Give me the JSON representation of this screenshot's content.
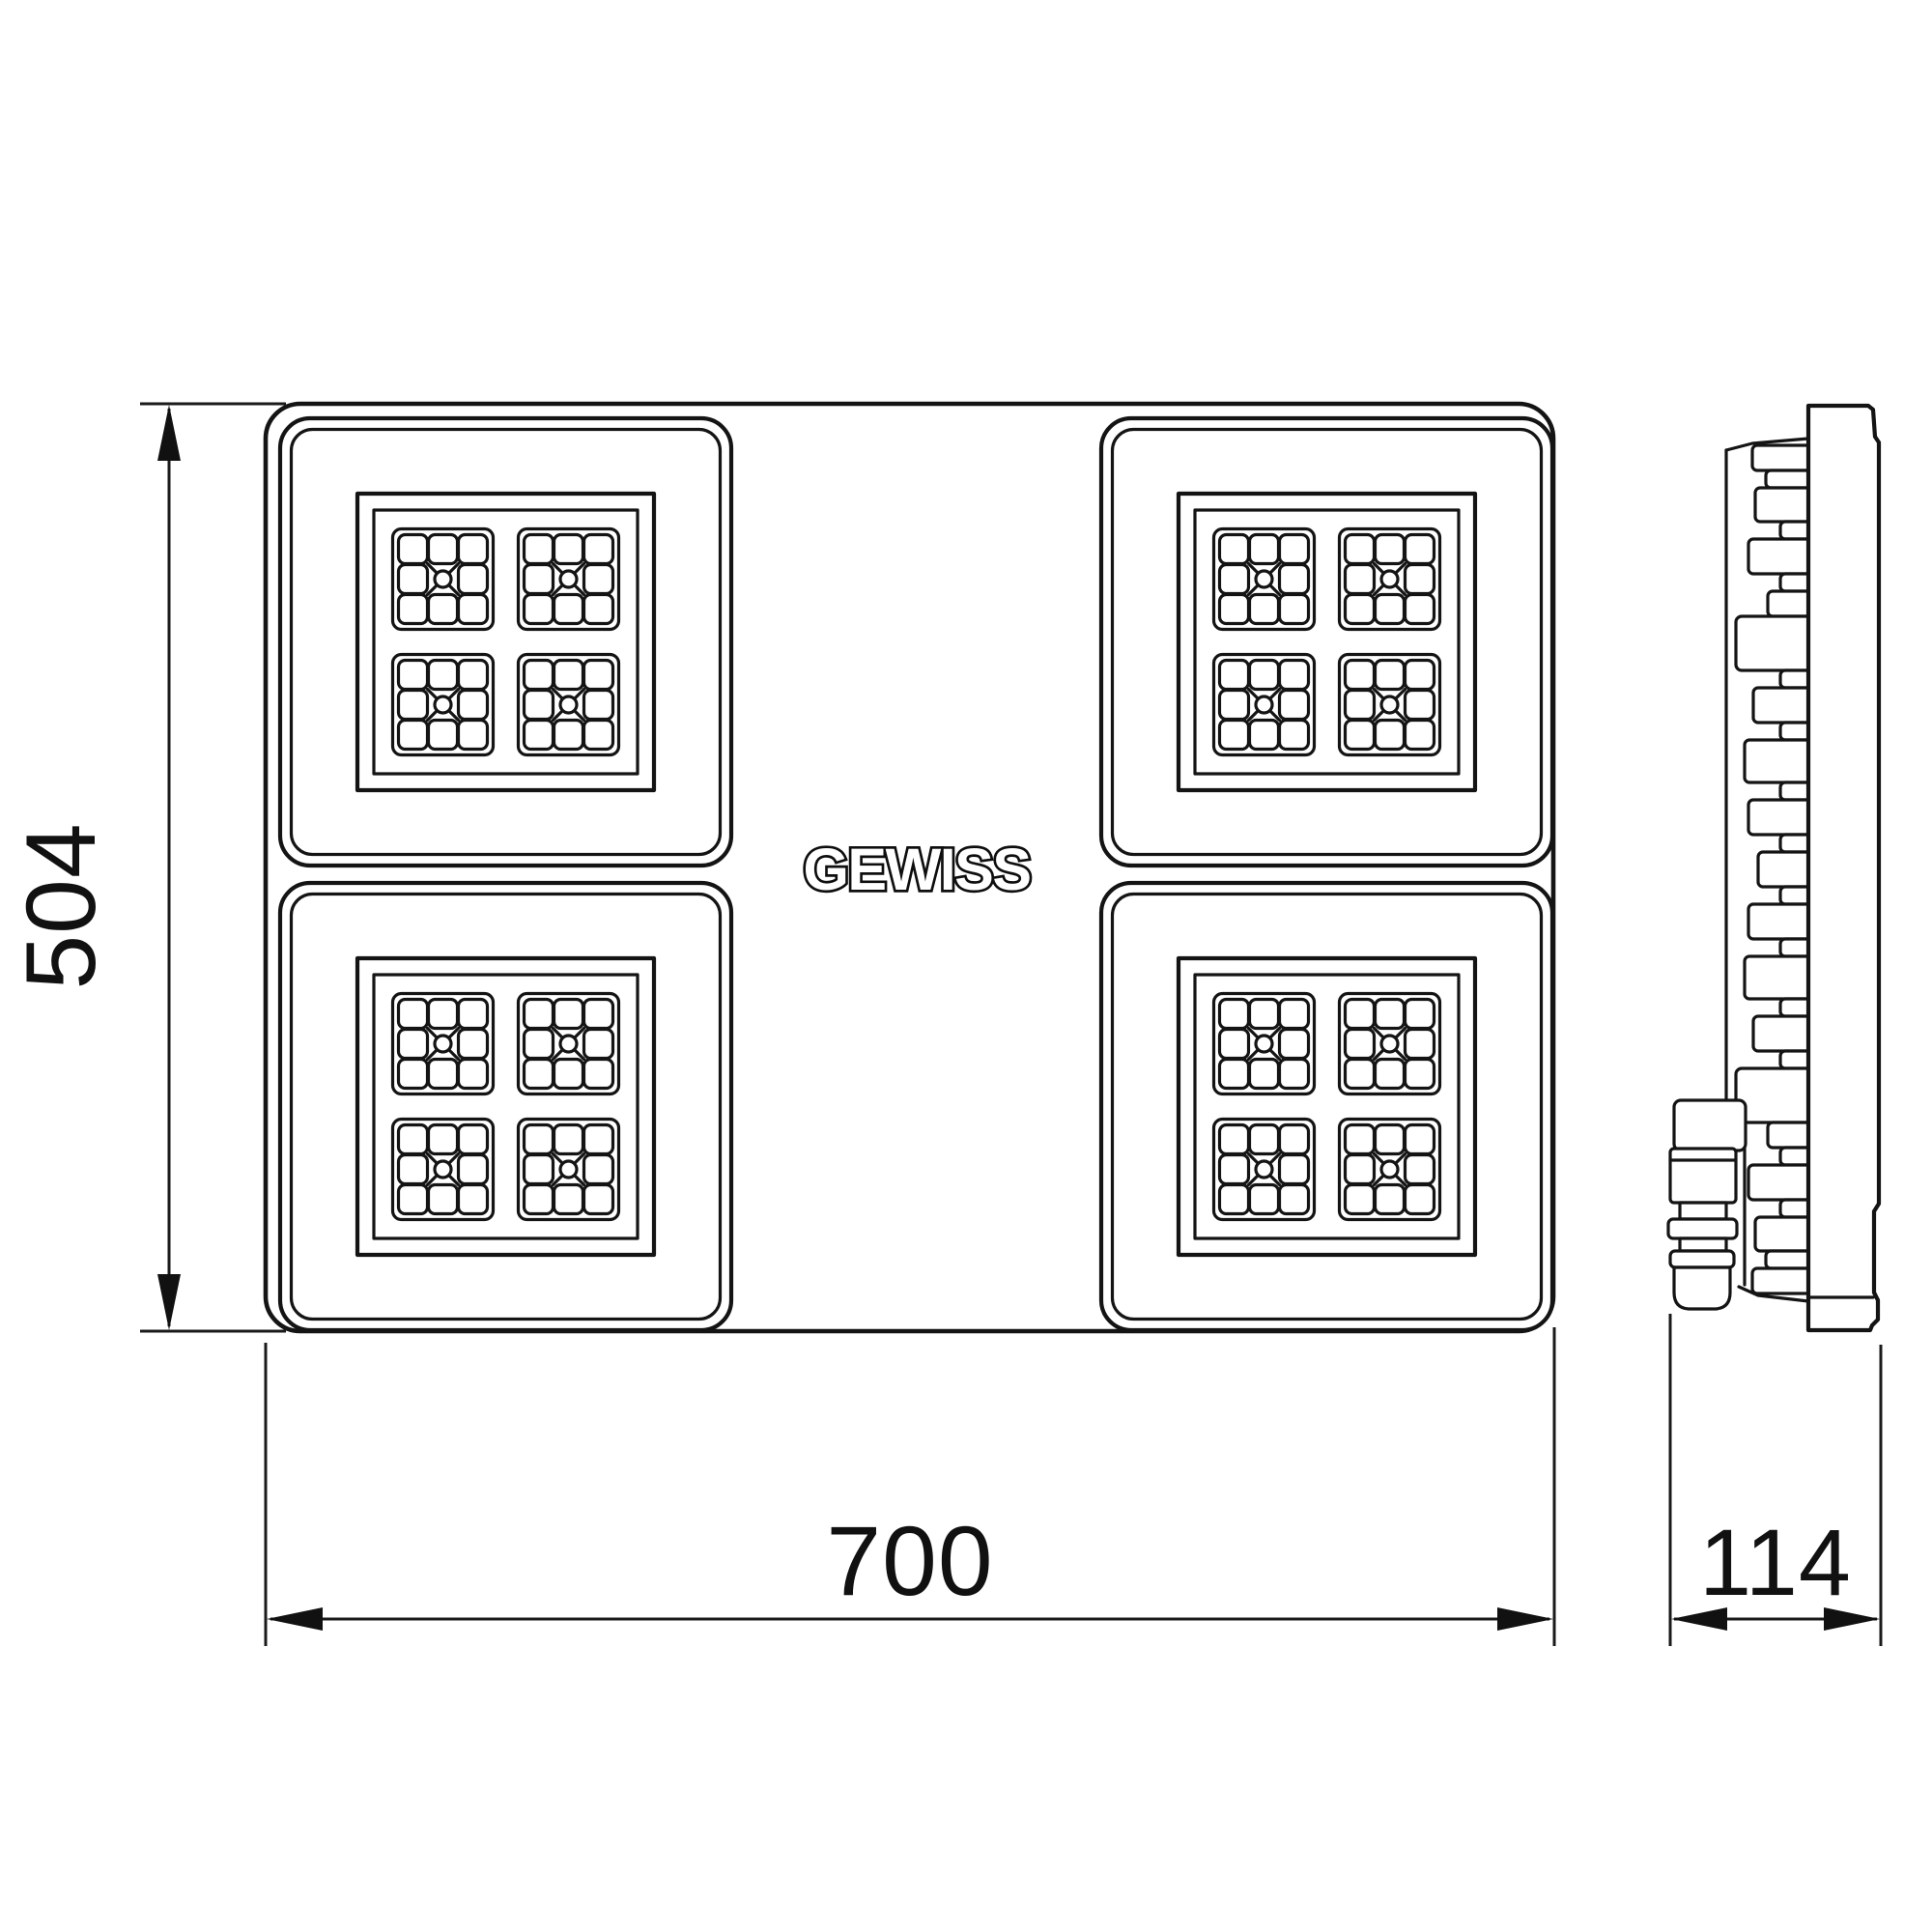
{
  "page": {
    "background": "#ffffff",
    "line_color": "#141414"
  },
  "drawing": {
    "brand_logo": "GEWISS",
    "dimensions": {
      "height": "504",
      "width": "700",
      "depth": "114"
    },
    "front_view": {
      "led_modules": 4,
      "clusters_per_module": 4,
      "cells_per_cluster": 9
    },
    "side_view": {
      "features": [
        "heatsink-fins",
        "mounting-bracket",
        "cable-gland",
        "front-frame"
      ]
    }
  }
}
